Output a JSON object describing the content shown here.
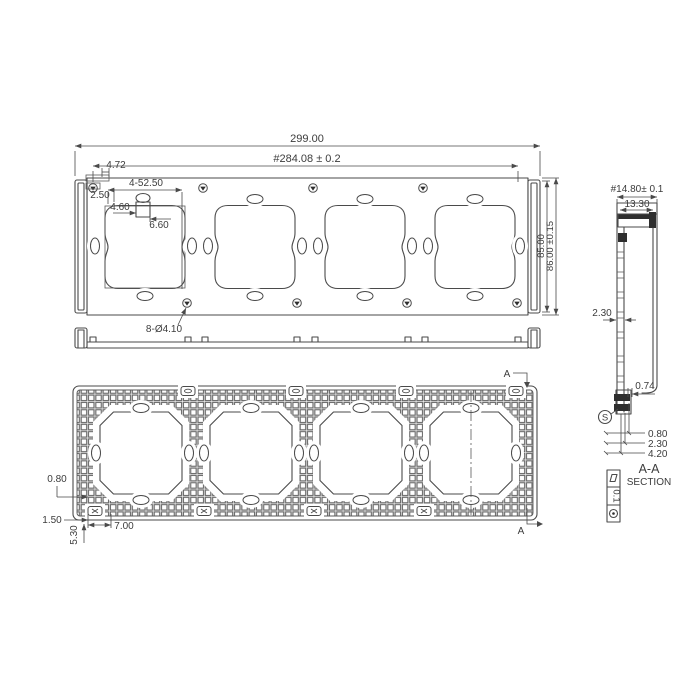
{
  "front": {
    "dim_width_total": "299.00",
    "dim_mount_span": "#284.08 ± 0.2",
    "dim_height": "85.00",
    "dim_height_tol": "86.00 ±0.15",
    "dim_clip_width": "4.72",
    "dim_clip_offset": "2.50",
    "dim_openings": "4-52.50",
    "dim_slot_width": "4.60",
    "dim_boss_width": "6.60",
    "dim_mount_holes": "8-Ø4.10"
  },
  "back": {
    "dim_rib": "0.80",
    "dim_edge": "1.50",
    "dim_corner_height": "5.30",
    "dim_corner_width": "7.00",
    "section_marker_top": "A",
    "section_marker_bottom": "A"
  },
  "section": {
    "dim_depth": "#14.80± 0.1",
    "dim_inner_depth": "13.30",
    "dim_wall": "2.30",
    "dim_lip": "0.74",
    "dim_step_1": "0.80",
    "dim_step_2": "2.30",
    "dim_step_3": "4.20",
    "surface_symbol": "S",
    "title_line1": "A-A",
    "title_line2": "SECTION",
    "flatness_value": "0.1"
  },
  "colors": {
    "line": "#4a4a4a",
    "dark": "#2e2e2e",
    "text": "#3c3c3c",
    "background": "#ffffff"
  }
}
